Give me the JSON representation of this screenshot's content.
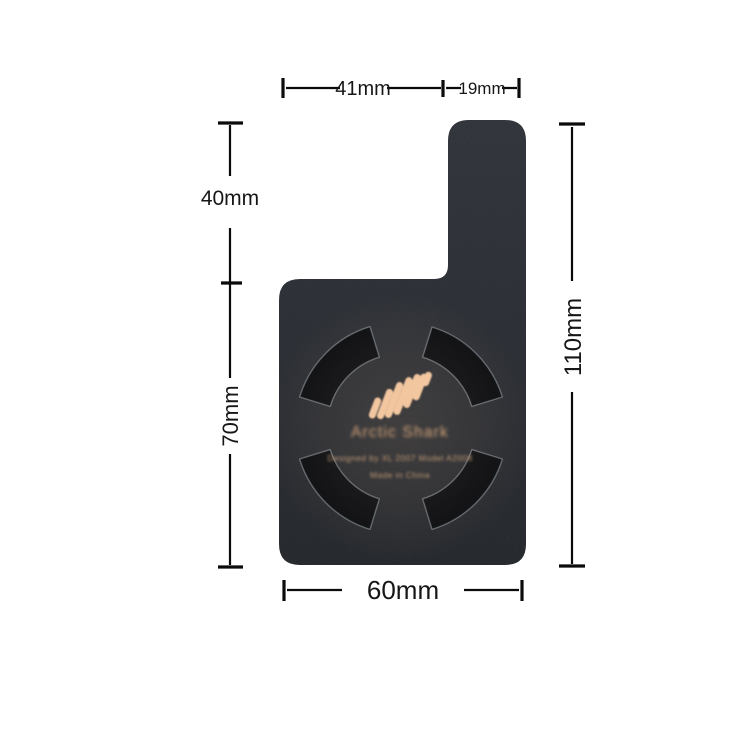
{
  "scene": {
    "background_color": "#ffffff"
  },
  "product": {
    "brand_label": "Arctic Shark",
    "info_label": "Designed by XL 2007 Model A2008",
    "origin_label": "Made in China",
    "colors": {
      "body": "#22252b",
      "slot": "#0c0e12",
      "slot_outline": "#98a0a8",
      "accent": "#f2c7a0",
      "brand_text": "#d3a47b",
      "small_text": "#bf9a77"
    }
  },
  "dimensions": {
    "line_color": "#0b0b0b",
    "labels": {
      "top_left": "41mm",
      "top_right": "19mm",
      "upper_left": "40mm",
      "lower_left": "70mm",
      "right": "110mm",
      "bottom": "60mm"
    }
  }
}
